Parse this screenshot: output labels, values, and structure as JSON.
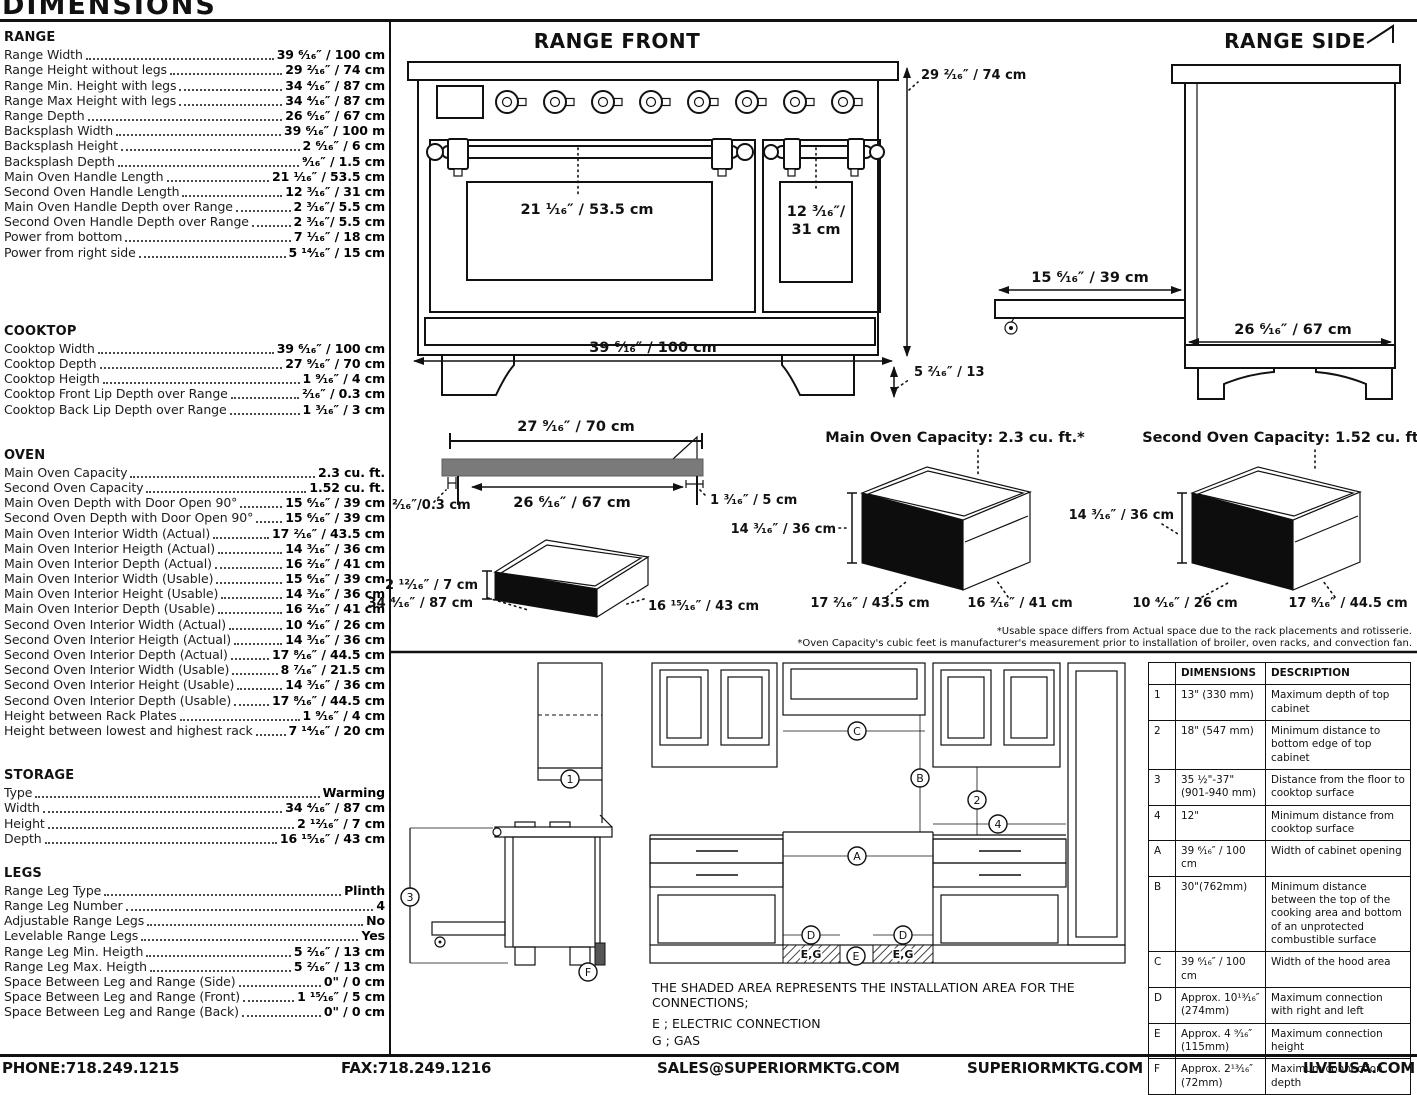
{
  "page": {
    "title": "DIMENSIONS"
  },
  "colors": {
    "ink": "#111111",
    "cooktop_gray": "#7a7a7a",
    "oven_face_black": "#0d0d0d"
  },
  "specs": {
    "sections": [
      {
        "title": "RANGE",
        "rows": [
          {
            "label": "Range Width",
            "value": "39 ⁶⁄₁₆″ / 100 cm"
          },
          {
            "label": "Range Height without legs",
            "value": "29 ²⁄₁₆″ / 74 cm"
          },
          {
            "label": "Range Min. Height with legs",
            "value": "34 ⁴⁄₁₆″ / 87 cm"
          },
          {
            "label": "Range Max Height with legs",
            "value": "34 ⁴⁄₁₆″ / 87 cm"
          },
          {
            "label": "Range Depth",
            "value": "26 ⁶⁄₁₆″ / 67 cm"
          },
          {
            "label": "Backsplash Width",
            "value": "39 ⁶⁄₁₆″ / 100 m"
          },
          {
            "label": "Backsplash Height",
            "value": "2 ⁶⁄₁₆″ / 6 cm"
          },
          {
            "label": "Backsplash Depth",
            "value": "⁹⁄₁₆″ / 1.5 cm"
          },
          {
            "label": "Main Oven Handle Length",
            "value": "21 ¹⁄₁₆″ / 53.5 cm"
          },
          {
            "label": "Second Oven Handle Length",
            "value": "12 ³⁄₁₆″ / 31 cm"
          },
          {
            "label": "Main Oven Handle Depth over Range",
            "value": "2 ³⁄₁₆″/ 5.5 cm"
          },
          {
            "label": "Second Oven Handle Depth over Range",
            "value": "2 ³⁄₁₆″/ 5.5 cm"
          },
          {
            "label": "Power from bottom",
            "value": "7 ¹⁄₁₆″ / 18 cm"
          },
          {
            "label": "Power from right side",
            "value": "5 ¹⁴⁄₁₆″ / 15 cm"
          }
        ]
      },
      {
        "title": "COOKTOP",
        "rows": [
          {
            "label": "Cooktop Width",
            "value": "39 ⁶⁄₁₆″ / 100 cm"
          },
          {
            "label": "Cooktop Depth",
            "value": "27 ⁹⁄₁₆″ / 70 cm"
          },
          {
            "label": "Cooktop Heigth",
            "value": "1 ⁹⁄₁₆″ / 4 cm"
          },
          {
            "label": "Cooktop Front Lip Depth over Range",
            "value": "²⁄₁₆″ / 0.3 cm"
          },
          {
            "label": "Cooktop Back Lip Depth over Range",
            "value": "1 ³⁄₁₆″ / 3 cm"
          }
        ]
      },
      {
        "title": "OVEN",
        "rows": [
          {
            "label": "Main Oven Capacity",
            "value": "2.3 cu. ft."
          },
          {
            "label": "Second Oven Capacity",
            "value": "1.52 cu. ft."
          },
          {
            "label": "Main Oven Depth with Door Open 90°",
            "value": "15 ⁶⁄₁₆″ / 39 cm"
          },
          {
            "label": "Second Oven Depth with Door Open 90°",
            "value": "15 ⁶⁄₁₆″ / 39 cm"
          },
          {
            "label": "Main Oven Interior Width (Actual)",
            "value": "17 ²⁄₁₆″ / 43.5 cm"
          },
          {
            "label": "Main Oven Interior Heigth (Actual)",
            "value": "14 ³⁄₁₆″ / 36 cm"
          },
          {
            "label": "Main Oven Interior Depth (Actual)",
            "value": "16 ²⁄₁₆″ / 41 cm"
          },
          {
            "label": "Main Oven Interior Width (Usable)",
            "value": "15 ⁶⁄₁₆″ / 39 cm"
          },
          {
            "label": "Main Oven Interior Height (Usable)",
            "value": "14 ³⁄₁₆″ / 36 cm"
          },
          {
            "label": "Main Oven Interior Depth (Usable)",
            "value": "16 ²⁄₁₆″ / 41 cm"
          },
          {
            "label": "Second Oven Interior Width (Actual)",
            "value": "10 ⁴⁄₁₆″ / 26 cm"
          },
          {
            "label": "Second Oven Interior Heigth (Actual)",
            "value": "14 ³⁄₁₆″ / 36 cm"
          },
          {
            "label": "Second Oven Interior Depth (Actual)",
            "value": "17 ⁸⁄₁₆″ / 44.5 cm"
          },
          {
            "label": "Second Oven Interior Width (Usable)",
            "value": "8 ⁷⁄₁₆″ / 21.5 cm"
          },
          {
            "label": "Second Oven Interior Height (Usable)",
            "value": "14 ³⁄₁₆″ / 36 cm"
          },
          {
            "label": "Second Oven Interior Depth (Usable)",
            "value": "17 ⁸⁄₁₆″ / 44.5 cm"
          },
          {
            "label": "Height between Rack Plates",
            "value": "1 ⁹⁄₁₆″ / 4 cm"
          },
          {
            "label": "Height between lowest and highest rack",
            "value": "7 ¹⁴⁄₁₆″ / 20 cm"
          }
        ]
      },
      {
        "title": "STORAGE",
        "rows": [
          {
            "label": "Type",
            "value": "Warming"
          },
          {
            "label": "Width",
            "value": "34 ⁴⁄₁₆″ / 87 cm"
          },
          {
            "label": "Height",
            "value": "2 ¹²⁄₁₆″ / 7 cm"
          },
          {
            "label": "Depth",
            "value": "16 ¹⁵⁄₁₆″ / 43 cm"
          }
        ]
      },
      {
        "title": "LEGS",
        "rows": [
          {
            "label": "Range Leg Type",
            "value": "Plinth"
          },
          {
            "label": "Range Leg Number",
            "value": "4"
          },
          {
            "label": "Adjustable Range Legs",
            "value": "No"
          },
          {
            "label": "Levelable Range Legs",
            "value": "Yes"
          },
          {
            "label": "Range Leg Min. Heigth",
            "value": "5 ²⁄₁₆″ / 13 cm"
          },
          {
            "label": "Range Leg Max. Heigth",
            "value": "5 ²⁄₁₆″ / 13 cm"
          },
          {
            "label": "Space Between Leg and Range (Side)",
            "value": "0\" / 0 cm"
          },
          {
            "label": "Space Between Leg and Range (Front)",
            "value": "1 ¹⁵⁄₁₆″ / 5 cm"
          },
          {
            "label": "Space Between Leg and Range (Back)",
            "value": "0\" / 0 cm"
          }
        ]
      }
    ]
  },
  "drawings": {
    "range_front": {
      "title": "RANGE FRONT",
      "main_door_label": "21 ¹⁄₁₆″ / 53.5 cm",
      "second_door_line1": "12 ³⁄₁₆″/",
      "second_door_line2": "31 cm",
      "width_label": "39 ⁶⁄₁₆″ / 100 cm",
      "height_label": "29 ²⁄₁₆″ / 74 cm",
      "leg_label": "5 ²⁄₁₆″ / 13"
    },
    "range_side": {
      "title": "RANGE SIDE",
      "door_label": "15 ⁶⁄₁₆″ / 39 cm",
      "depth_label": "26 ⁶⁄₁₆″ / 67 cm"
    },
    "cooktop_profile": {
      "top_label": "27 ⁹⁄₁₆″ / 70 cm",
      "width_label": "26 ⁶⁄₁₆″ / 67 cm",
      "right_label": "1 ³⁄₁₆″ / 5 cm",
      "left_label": "²⁄₁₆″/0.3 cm"
    },
    "storage_drawer": {
      "height_label": "2 ¹²⁄₁₆″ / 7 cm",
      "width_label": "34 ⁴⁄₁₆″ / 87 cm",
      "depth_label": "16 ¹⁵⁄₁₆″ / 43 cm"
    },
    "main_oven": {
      "title": "Main Oven Capacity: 2.3 cu. ft.*",
      "height_label": "14 ³⁄₁₆″ / 36 cm",
      "width_label": "17 ²⁄₁₆″ / 43.5 cm",
      "depth_label": "16 ²⁄₁₆″ / 41 cm"
    },
    "second_oven": {
      "title": "Second Oven Capacity: 1.52 cu. ft.*",
      "height_label": "14 ³⁄₁₆″ / 36 cm",
      "width_label": "10 ⁴⁄₁₆″ / 26 cm",
      "depth_label": "17 ⁸⁄₁₆″ / 44.5 cm"
    },
    "notes": {
      "line1": "*Usable space differs from Actual space due to the rack placements and rotisserie.",
      "line2": "*Oven Capacity's cubic feet is manufacturer's measurement prior to installation of broiler, oven racks, and convection fan."
    }
  },
  "installation": {
    "callouts": {
      "n1": "1",
      "n2": "2",
      "n3": "3",
      "n4": "4",
      "A": "A",
      "B": "B",
      "C": "C",
      "D": "D",
      "E": "E",
      "F": "F"
    },
    "shaded_label": "E,G",
    "note": "THE SHADED AREA REPRESENTS THE INSTALLATION AREA FOR THE CONNECTIONS;",
    "electric": "E ; ELECTRIC CONNECTION",
    "gas": "G ; GAS"
  },
  "table": {
    "headers": [
      "",
      "DIMENSIONS",
      "DESCRIPTION"
    ],
    "rows": [
      {
        "ref": "1",
        "dim": "13\" (330 mm)",
        "desc": "Maximum depth of top cabinet"
      },
      {
        "ref": "2",
        "dim": "18\" (547 mm)",
        "desc": "Minimum distance to bottom edge of top cabinet"
      },
      {
        "ref": "3",
        "dim": "35 ½\"-37\" (901-940 mm)",
        "desc": "Distance from the floor to cooktop surface"
      },
      {
        "ref": "4",
        "dim": "12\"",
        "desc": "Minimum distance from cooktop surface"
      },
      {
        "ref": "A",
        "dim": "39 ⁶⁄₁₆″ / 100 cm",
        "desc": "Width of cabinet opening"
      },
      {
        "ref": "B",
        "dim": "30\"(762mm)",
        "desc": "Minimum distance between the top of the cooking area and bottom of an unprotected combustible surface"
      },
      {
        "ref": "C",
        "dim": "39 ⁶⁄₁₆″ / 100 cm",
        "desc": "Width of the hood area"
      },
      {
        "ref": "D",
        "dim": "Approx. 10¹³⁄₁₆″ (274mm)",
        "desc": "Maximum connection with right and left"
      },
      {
        "ref": "E",
        "dim": "Approx. 4 ⁹⁄₁₆″ (115mm)",
        "desc": "Maximum connection height"
      },
      {
        "ref": "F",
        "dim": "Approx. 2¹³⁄₁₆″ (72mm)",
        "desc": "Maximum connection depth"
      }
    ]
  },
  "footer": {
    "phone": "PHONE:718.249.1215",
    "fax": "FAX:718.249.1216",
    "sales": "SALES@SUPERIORMKTG.COM",
    "site": "SUPERIORMKTG.COM",
    "ilve": "ILVEUSA.COM"
  }
}
